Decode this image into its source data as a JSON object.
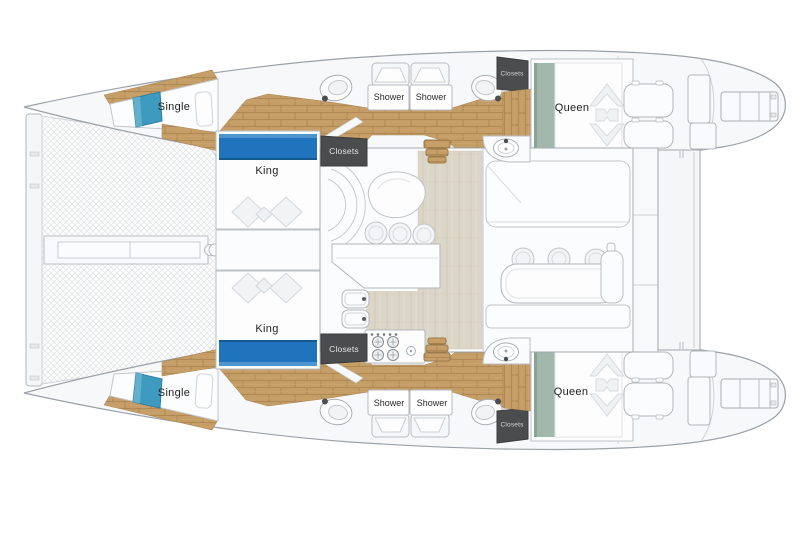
{
  "plan": {
    "name": "Catamaran yacht floor plan",
    "labels": {
      "single_top": "Single",
      "single_bottom": "Single",
      "king_top": "King",
      "king_bottom": "King",
      "queen_top": "Queen",
      "queen_bottom": "Queen",
      "shower_top_fwd": "Shower",
      "shower_top_aft": "Shower",
      "shower_bottom_fwd": "Shower",
      "shower_bottom_aft": "Shower",
      "closets_mid_top": "Closets",
      "closets_mid_bottom": "Closets",
      "closets_aft_top": "Closets",
      "closets_aft_bottom": "Closets"
    },
    "colors": {
      "king_bed_accent": "#1f74bd",
      "single_bed_accent": "#3e9abf",
      "queen_bed_accent": "#a3b8ad",
      "wood_floor": "#c59d66",
      "tile_floor": "#dcd6c9",
      "closet_box": "#4b4c4e",
      "deck": "#f7f8f9",
      "outline": "#9aa1a8",
      "label_text": "#222222"
    }
  }
}
